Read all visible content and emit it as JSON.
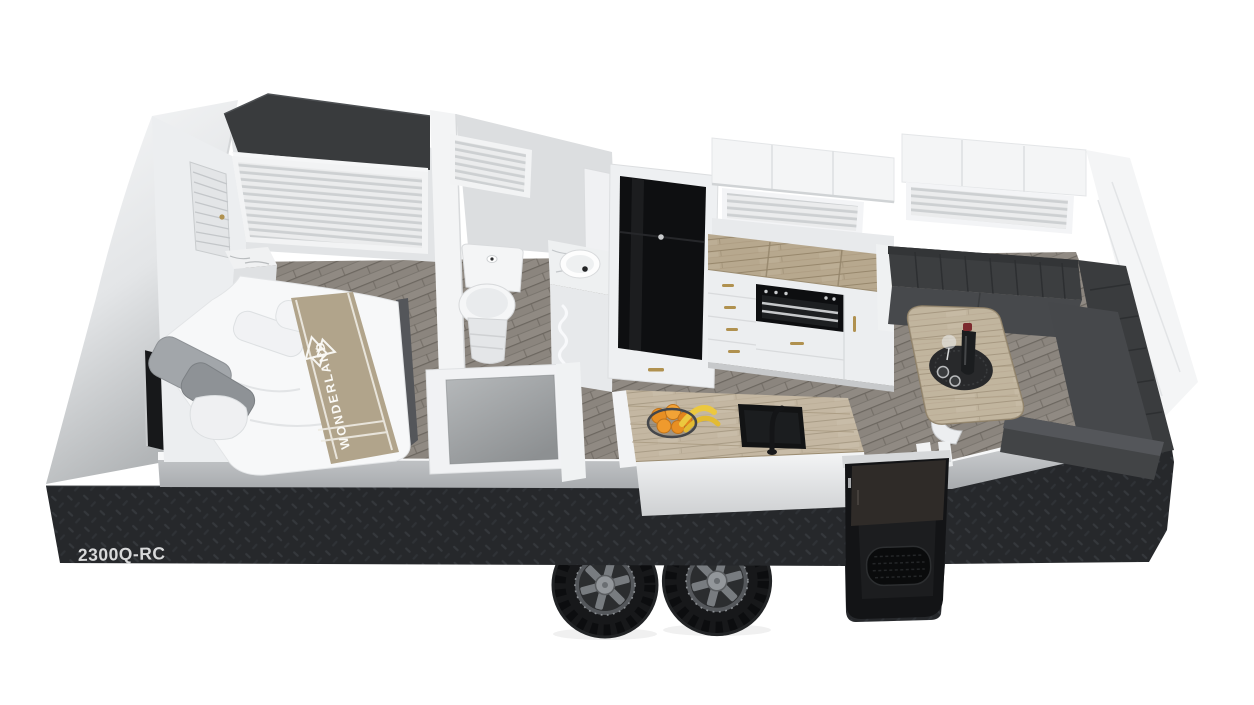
{
  "labels": {
    "model_code": "2300Q-RC",
    "brand_wordmark": "WONDERLAND",
    "brand_wordmark_suffix": "RV"
  },
  "palette": {
    "background": "#ffffff",
    "checkerplate_skirt": "#26282b",
    "checkerplate_highlight": "#35383c",
    "body_white": "#f4f5f6",
    "silver_floor_trim": "#c6c8ca",
    "interior_wall_grey": "#dcdee0",
    "floor_wood_grey": "#8b857e",
    "bench_wood_tan": "#b7a88e",
    "upholstery_charcoal": "#3e4043",
    "bed_runner_taupe": "#b1a48b",
    "appliance_black": "#0e0f11",
    "handle_brass": "#b0914f",
    "fruit_orange": "#e88f23",
    "fruit_banana": "#e8c43c",
    "wine_cap_red": "#7c2a2e",
    "tyre_black": "#17181a",
    "rim_grey": "#55585c"
  },
  "scene": {
    "type": "caravan-cutaway-floorplan-render",
    "view": "isometric-from-above",
    "wheel_count": 2,
    "rooms": [
      "bedroom",
      "ensuite-bathroom",
      "kitchen",
      "dinette-lounge"
    ],
    "objects": [
      "checkerplate-skirt",
      "tandem-wheels",
      "front-wall-tv",
      "queen-bed",
      "bed-runner-with-brand",
      "pillows",
      "louvre-wardrobe-door",
      "marble-bedside-table",
      "front-window-blind",
      "bathroom-window-blind",
      "toilet",
      "vanity-basin",
      "towel-rail-cabinet",
      "shower-recess",
      "black-fridge-freezer",
      "kitchen-overhead-cabinets",
      "kitchen-window-blind",
      "kitchen-bench-oven-grill",
      "island-bench",
      "black-island-sink",
      "fruit-bowl",
      "l-shaped-lounge",
      "dinette-table",
      "wine-bottle-and-glasses",
      "rear-overhead-cabinets",
      "rear-window-blind",
      "entry-door-step"
    ]
  }
}
